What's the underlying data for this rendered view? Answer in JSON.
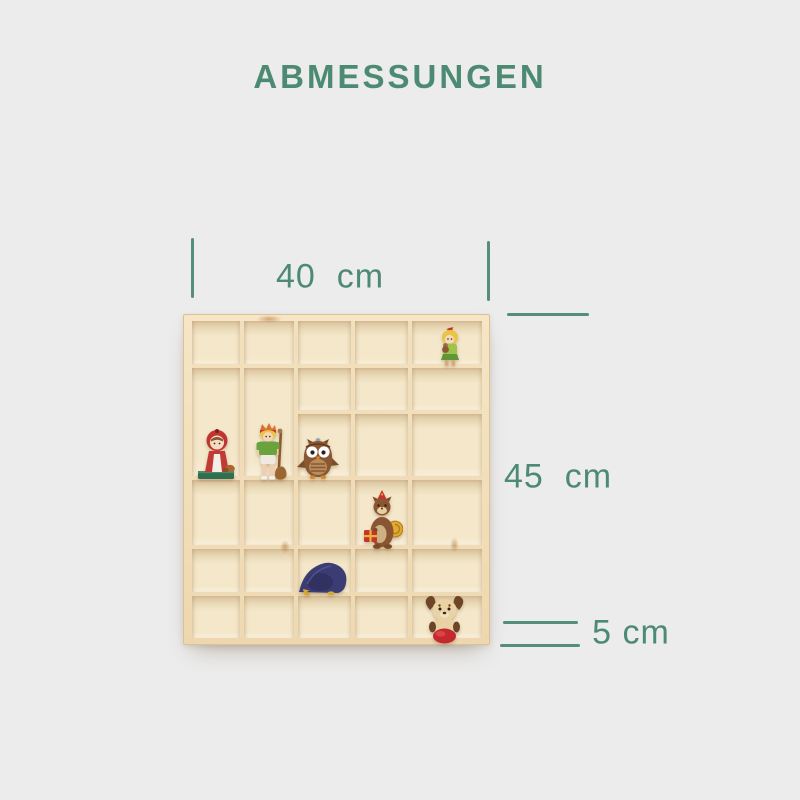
{
  "title": "ABMESSUNGEN",
  "theme": {
    "accent_color": "#4d8a73",
    "background_color": "#ececec",
    "wood_frame_color": "#f2dfbc",
    "wood_cell_color": "#f4e7ca"
  },
  "dimensions": {
    "width": {
      "label": "40  cm"
    },
    "height": {
      "label": "45  cm"
    },
    "depth": {
      "label": "5 cm"
    }
  },
  "shelf": {
    "type": "wooden display type case, 5 columns",
    "figurines": [
      {
        "icon": "gnome-girl-figurine"
      },
      {
        "icon": "red-riding-hood-figurine"
      },
      {
        "icon": "boy-with-stick-figurine"
      },
      {
        "icon": "owl-figurine"
      },
      {
        "icon": "squirrel-with-gift-figurine"
      },
      {
        "icon": "sleeping-blue-creature-figurine"
      },
      {
        "icon": "dog-with-ball-figurine"
      }
    ]
  }
}
